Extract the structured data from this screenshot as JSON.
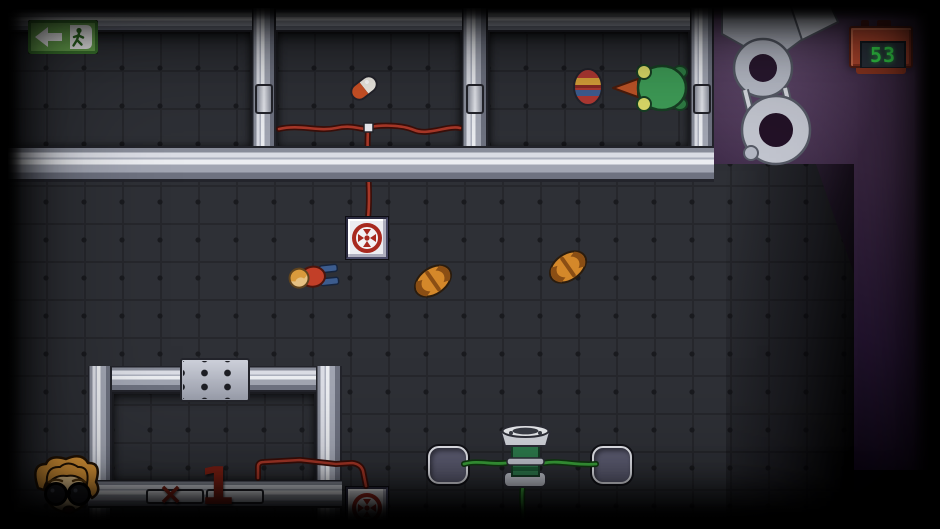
{
  "hud": {
    "exit_sign": {
      "icon": "exit-running-man-arrow-left",
      "bg": "#6fae54"
    },
    "timer": {
      "icon": "crt-monitor-timer",
      "value": "53",
      "digit_color": "#38e24e",
      "frame_color": "#b5482f"
    },
    "lives": {
      "portrait_icon": "worried-man-with-glasses",
      "times_symbol": "×",
      "count": "1",
      "text_color": "#7c2014"
    }
  },
  "entities": {
    "items": [
      "pill-capsule",
      "painted-egg",
      "frog"
    ],
    "creatures": [
      "grub-creature",
      "grub-creature"
    ],
    "player": "scientist-top-down",
    "devices": [
      "red-button-panel",
      "red-button-panel-bottom",
      "green-dispenser",
      "socket-pad-left",
      "socket-pad-right",
      "dot-vent-panel",
      "robotic-arm"
    ]
  },
  "colors": {
    "wire_red": "#a83828",
    "wire_green": "#3da63d",
    "floor": "#2e3036",
    "wall_light": "#dcdee6",
    "outside_purple": "#3a2742"
  }
}
